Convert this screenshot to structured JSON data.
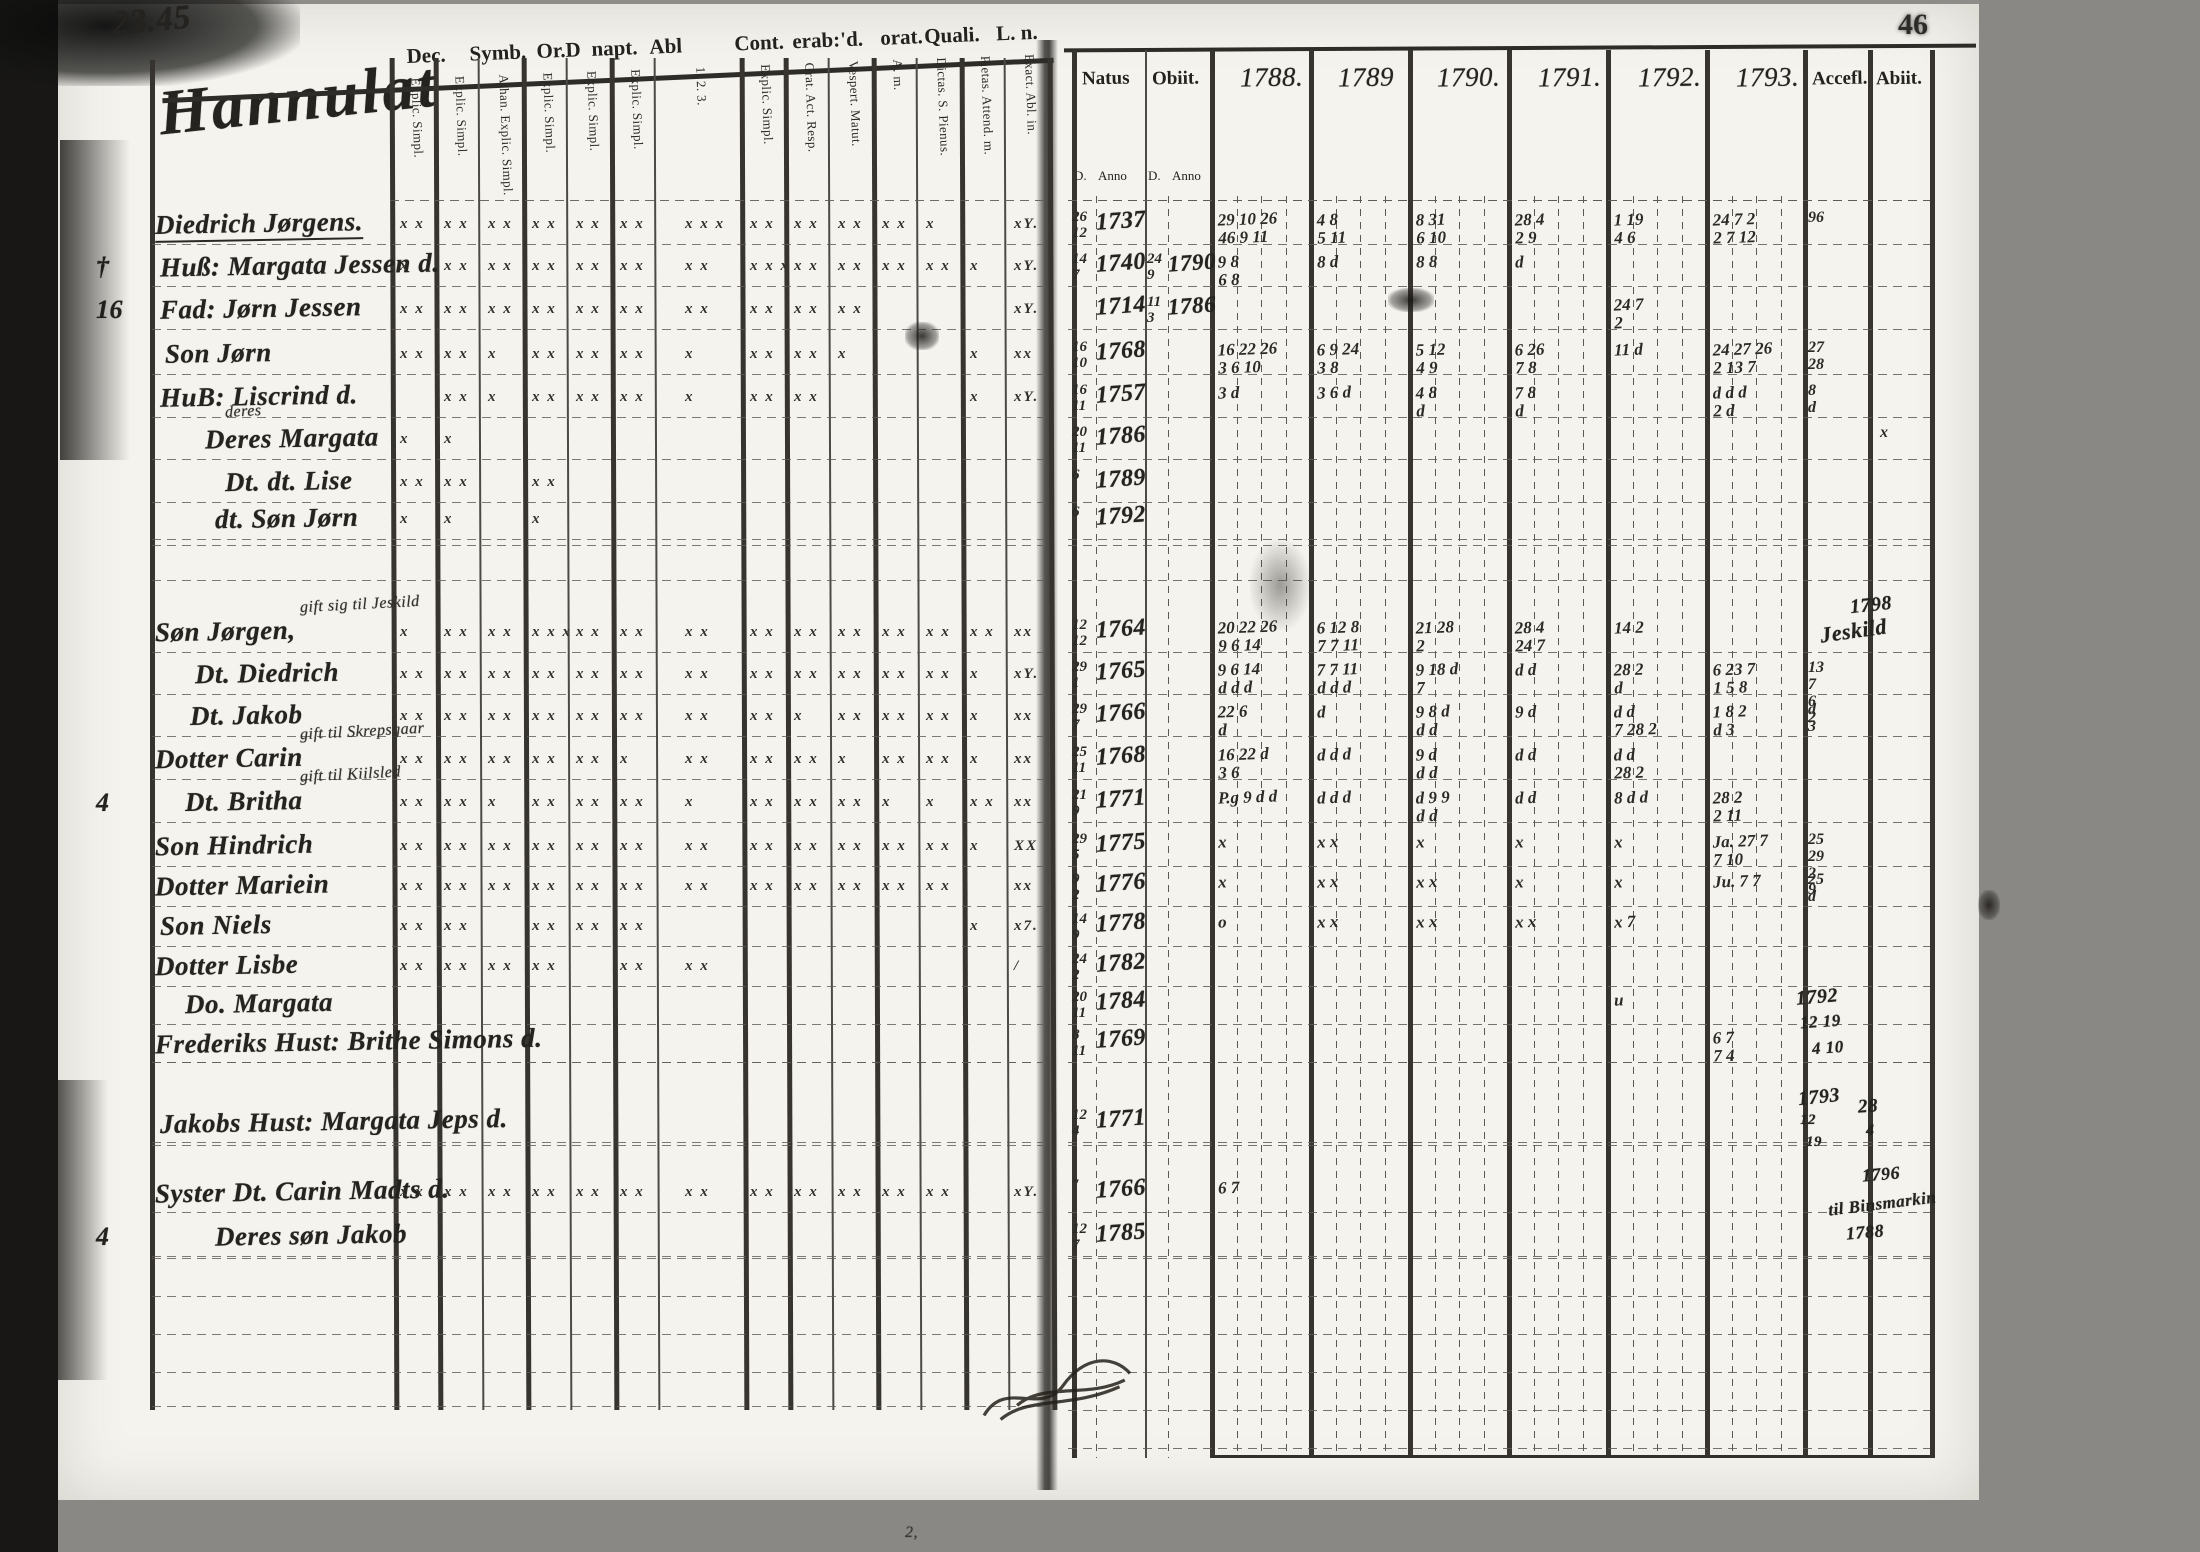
{
  "page": {
    "left_page_no": "23.45",
    "right_page_no": "46",
    "bottom_mark": "2,"
  },
  "ink_color": "#25231f",
  "paper_color": "#f4f3ee",
  "left": {
    "title_script": "Hannulat",
    "header_groups": [
      "Dec.",
      "Symb.",
      "Or.D",
      "napt.",
      "Abl",
      "Cont.",
      "erab:",
      "'d.",
      "orat.",
      "Quali.",
      "L. n."
    ],
    "sub_columns": [
      "Explic. Simpl.",
      "Explic. Simpl.",
      "Athan. Explic. Simpl.",
      "Explic. Simpl.",
      "Explic. Simpl.",
      "Explic. Simpl.",
      "1. 2. 3.",
      "Explic. Simpl.",
      "Grat. Act. Resp.",
      "Vespert. Matut.",
      "A. m.",
      "Dictas. S. Pienus.",
      "Pietas. Attend. m.",
      "Exact. Abl. in."
    ],
    "rows": [
      {
        "margin": "",
        "ind": 0,
        "name": "Diedrich Jørgens.",
        "note": "",
        "marks": "22222232222101",
        "tail": "xY."
      },
      {
        "margin": "†",
        "ind": 5,
        "name": "Huß: Margata Jessen d.",
        "note": "",
        "marks": "12222223222211",
        "tail": "xY."
      },
      {
        "margin": "16",
        "ind": 5,
        "name": "Fad: Jørn Jessen",
        "note": "",
        "marks": "22222222220001",
        "tail": "xY."
      },
      {
        "margin": "",
        "ind": 10,
        "name": "Son Jørn",
        "note": "",
        "marks": "22122212210011",
        "tail": "xx"
      },
      {
        "margin": "",
        "ind": 5,
        "name": "HuB: Liscrind d.",
        "note": "",
        "marks": "02122212200011",
        "tail": "xY."
      },
      {
        "margin": "",
        "ind": 50,
        "name": "Deres Margata",
        "note": "deres",
        "marks": "11000000000000",
        "tail": ""
      },
      {
        "margin": "",
        "ind": 70,
        "name": "Dt. dt. Lise",
        "note": "",
        "marks": "22020000000000",
        "tail": ""
      },
      {
        "margin": "",
        "ind": 60,
        "name": "dt. Søn Jørn",
        "note": "",
        "marks": "11010000000000",
        "tail": ""
      },
      {
        "margin": "",
        "ind": 0,
        "name": "Søn Jørgen,",
        "note": "gift sig til Jeskild",
        "marks": "12232222222222",
        "tail": "xx"
      },
      {
        "margin": "",
        "ind": 40,
        "name": "Dt. Diedrich",
        "note": "",
        "marks": "22222222222211",
        "tail": "xY."
      },
      {
        "margin": "",
        "ind": 35,
        "name": "Dt. Jakob",
        "note": "",
        "marks": "22222222122211",
        "tail": "xx"
      },
      {
        "margin": "",
        "ind": 0,
        "name": "Dotter Carin",
        "note": "gift til Skrepsgaar",
        "marks": "22222122212210",
        "tail": "xx"
      },
      {
        "margin": "4",
        "ind": 30,
        "name": "Dt.  Britha",
        "note": "gift til Kiilsled",
        "marks": "22122212221121",
        "tail": "xx"
      },
      {
        "margin": "",
        "ind": 0,
        "name": "Son Hindrich",
        "note": "",
        "marks": "22222222222210",
        "tail": "XX"
      },
      {
        "margin": "",
        "ind": 0,
        "name": "Dotter Mariein",
        "note": "",
        "marks": "22222222222200",
        "tail": "xx"
      },
      {
        "margin": "",
        "ind": 5,
        "name": "Son Niels",
        "note": "",
        "marks": "22022200000010",
        "tail": "x7."
      },
      {
        "margin": "",
        "ind": 0,
        "name": "Dotter Lisbe",
        "note": "",
        "marks": "22220220000000",
        "tail": "/"
      },
      {
        "margin": "",
        "ind": 30,
        "name": "Do.  Margata",
        "note": "",
        "marks": "00000000000000",
        "tail": ""
      },
      {
        "margin": "",
        "ind": 0,
        "name": "Frederiks Hust: Brithe Simons d.",
        "note": "",
        "marks": "00000000000000",
        "tail": ""
      },
      {
        "margin": "",
        "ind": 5,
        "name": "Jakobs Hust: Margata Jeps d.",
        "note": "",
        "marks": "00000000000000",
        "tail": ""
      },
      {
        "margin": "",
        "ind": 0,
        "name": "Syster Dt. Carin Madts d.",
        "note": "",
        "marks": "22222222222201",
        "tail": "xY."
      },
      {
        "margin": "4",
        "ind": 60,
        "name": "Deres søn Jakob",
        "note": "",
        "marks": "00000000000000",
        "tail": ""
      }
    ]
  },
  "right": {
    "headers": [
      "Natus",
      "Obiit.",
      "1788.",
      "1789",
      "1790.",
      "1791.",
      "1792.",
      "1793.",
      "Accefl.",
      "Abiit."
    ],
    "subheaders": [
      "D.",
      "Anno",
      "D.",
      "Anno"
    ],
    "rows": [
      {
        "nd": "26|12",
        "ny": "1737",
        "od": "",
        "oy": "",
        "y": [
          "29 10 26|46 9 11",
          "4 8|5 11",
          "8 31|6 10",
          "28 4|2 9",
          "1 19|4 6",
          "24 7 2|2 7 12"
        ],
        "acc": "96",
        "ab": ""
      },
      {
        "nd": "14|7",
        "ny": "1740",
        "od": "24|9",
        "oy": "1790",
        "y": [
          "9 8|6 8",
          "8 d",
          "8 8",
          "d",
          "",
          ""
        ],
        "acc": "",
        "ab": ""
      },
      {
        "nd": "",
        "ny": "1714",
        "od": "11|3",
        "oy": "1786",
        "y": [
          "",
          "",
          "",
          "",
          "24 7|2",
          ""
        ],
        "acc": "",
        "ab": ""
      },
      {
        "nd": "16|10",
        "ny": "1768",
        "od": "",
        "oy": "",
        "y": [
          "16 22 26|3 6 10",
          "6 9 24|3 8",
          "5 12|4 9",
          "6 26|7 8",
          "11 d",
          "24 27 26|2 13 7"
        ],
        "acc": "27 28",
        "ab": ""
      },
      {
        "nd": "16|11",
        "ny": "1757",
        "od": "",
        "oy": "",
        "y": [
          "3 d",
          "3 6 d",
          "4 8|d",
          "7 8|d",
          "",
          "d d d|2 d"
        ],
        "acc": "8 d",
        "ab": ""
      },
      {
        "nd": "20|11",
        "ny": "1786",
        "od": "",
        "oy": "",
        "y": [
          "",
          "",
          "",
          "",
          "",
          ""
        ],
        "acc": "",
        "ab": "x"
      },
      {
        "nd": "6",
        "ny": "1789",
        "od": "",
        "oy": "",
        "y": [
          "",
          "",
          "",
          "",
          "",
          ""
        ],
        "acc": "",
        "ab": ""
      },
      {
        "nd": "6",
        "ny": "1792",
        "od": "",
        "oy": "",
        "y": [
          "",
          "",
          "",
          "",
          "",
          ""
        ],
        "acc": "",
        "ab": ""
      },
      {
        "nd": "12|12",
        "ny": "1764",
        "od": "",
        "oy": "",
        "y": [
          "20 22 26|9 6 14",
          "6 12 8|7 7 11",
          "21 28|2",
          "28 4|24 7",
          "14 2",
          ""
        ],
        "acc": "",
        "ab": ""
      },
      {
        "nd": "29|1",
        "ny": "1765",
        "od": "",
        "oy": "",
        "y": [
          "9 6 14|d d d",
          "7 7 11|d d d",
          "9 18 d|7",
          "d d",
          "28 2|d",
          "6 23 7|1 5 8"
        ],
        "acc": "13 7|6 2",
        "ab": ""
      },
      {
        "nd": "29|7",
        "ny": "1766",
        "od": "",
        "oy": "",
        "y": [
          "22 6|d",
          "d",
          "9 8 d|d d",
          "9 d",
          "d d|7 28 2",
          "1 8 2|d 3"
        ],
        "acc": "d 3",
        "ab": ""
      },
      {
        "nd": "25|11",
        "ny": "1768",
        "od": "",
        "oy": "",
        "y": [
          "16 22 d|3 6",
          "d d d",
          "9 d|d d",
          "d d",
          "d d|28 2",
          ""
        ],
        "acc": "",
        "ab": ""
      },
      {
        "nd": "21|9",
        "ny": "1771",
        "od": "",
        "oy": "",
        "y": [
          "P.g 9 d d",
          "d d d",
          "d 9 9|d d",
          "d d",
          "8 d d",
          "28 2|2 11"
        ],
        "acc": "",
        "ab": ""
      },
      {
        "nd": "29|5",
        "ny": "1775",
        "od": "",
        "oy": "",
        "y": [
          "x",
          "x x",
          "x",
          "x",
          "x",
          "Ja. 27 7|7 10"
        ],
        "acc": "25 29|2 9",
        "ab": ""
      },
      {
        "nd": "9|2",
        "ny": "1776",
        "od": "",
        "oy": "",
        "y": [
          "x",
          "x x",
          "x x",
          "x",
          "x",
          "Ju. 7 7"
        ],
        "acc": "25 d",
        "ab": ""
      },
      {
        "nd": "14|9",
        "ny": "1778",
        "od": "",
        "oy": "",
        "y": [
          "o",
          "x x",
          "x x",
          "x x",
          "x 7",
          ""
        ],
        "acc": "",
        "ab": ""
      },
      {
        "nd": "24|2",
        "ny": "1782",
        "od": "",
        "oy": "",
        "y": [
          "",
          "",
          "",
          "",
          "",
          ""
        ],
        "acc": "",
        "ab": ""
      },
      {
        "nd": "20|11",
        "ny": "1784",
        "od": "",
        "oy": "",
        "y": [
          "",
          "",
          "",
          "",
          "u",
          ""
        ],
        "acc": "",
        "ab": ""
      },
      {
        "nd": "8|11",
        "ny": "1769",
        "od": "",
        "oy": "",
        "y": [
          "",
          "",
          "",
          "",
          "",
          "6 7|7 4"
        ],
        "acc": "",
        "ab": ""
      },
      {
        "nd": "12|4",
        "ny": "1771",
        "od": "",
        "oy": "",
        "y": [
          "",
          "",
          "",
          "",
          "",
          ""
        ],
        "acc": "",
        "ab": ""
      },
      {
        "nd": "″",
        "ny": "1766",
        "od": "",
        "oy": "",
        "y": [
          "6 7",
          "",
          "",
          "",
          "",
          ""
        ],
        "acc": "",
        "ab": ""
      },
      {
        "nd": "12|7",
        "ny": "1785",
        "od": "",
        "oy": "",
        "y": [
          "",
          "",
          "",
          "",
          "",
          ""
        ],
        "acc": "",
        "ab": ""
      }
    ],
    "annotations": [
      {
        "text": "1798",
        "x": 1850,
        "y": 594,
        "size": 20,
        "rot": -6
      },
      {
        "text": "Jeskild",
        "x": 1820,
        "y": 618,
        "size": 22,
        "rot": -8
      },
      {
        "text": "1792",
        "x": 1796,
        "y": 986,
        "size": 20,
        "rot": -5
      },
      {
        "text": "12 19",
        "x": 1800,
        "y": 1012,
        "size": 17,
        "rot": -4
      },
      {
        "text": "4 10",
        "x": 1812,
        "y": 1038,
        "size": 17,
        "rot": -4
      },
      {
        "text": "1793",
        "x": 1798,
        "y": 1086,
        "size": 20,
        "rot": -6
      },
      {
        "text": "12",
        "x": 1800,
        "y": 1112,
        "size": 15,
        "rot": 0
      },
      {
        "text": "19",
        "x": 1806,
        "y": 1134,
        "size": 15,
        "rot": 0
      },
      {
        "text": "28",
        "x": 1858,
        "y": 1096,
        "size": 19,
        "rot": -4
      },
      {
        "text": "4",
        "x": 1866,
        "y": 1122,
        "size": 16,
        "rot": 0
      },
      {
        "text": "1796",
        "x": 1862,
        "y": 1164,
        "size": 18,
        "rot": -5
      },
      {
        "text": "til Binsmarkin",
        "x": 1828,
        "y": 1194,
        "size": 17,
        "rot": -7
      },
      {
        "text": "1788",
        "x": 1846,
        "y": 1222,
        "size": 18,
        "rot": -5
      }
    ]
  }
}
